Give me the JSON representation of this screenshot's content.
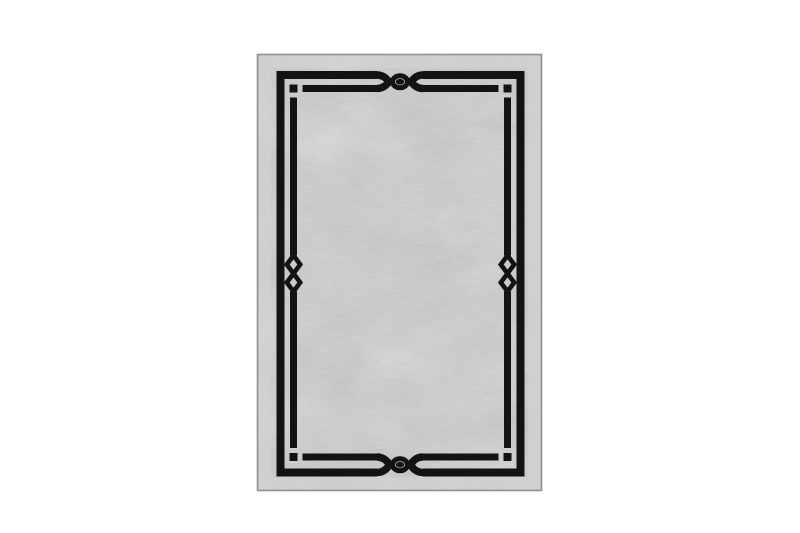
{
  "page": {
    "background": "#ffffff",
    "description": "Product photograph of a rectangular area rug centered on a plain white background"
  },
  "rug": {
    "name": "Gray distressed rug with black double-line knot border",
    "colors": {
      "field": "#c3c4c3",
      "margin_band": "#d4d4d3",
      "edge_line": "#8f908f",
      "frame": "#131313",
      "background": "#ffffff"
    },
    "design": {
      "border_style": "double black line frame",
      "top_motif": "eye knot (cross, ring and center dot)",
      "bottom_motif": "eye knot (cross, ring and center dot)",
      "left_motif": "vertical chain knot (two stacked diamonds)",
      "right_motif": "vertical chain knot (two stacked diamonds)",
      "corner_motif": "broken inner corner with detached square"
    }
  }
}
